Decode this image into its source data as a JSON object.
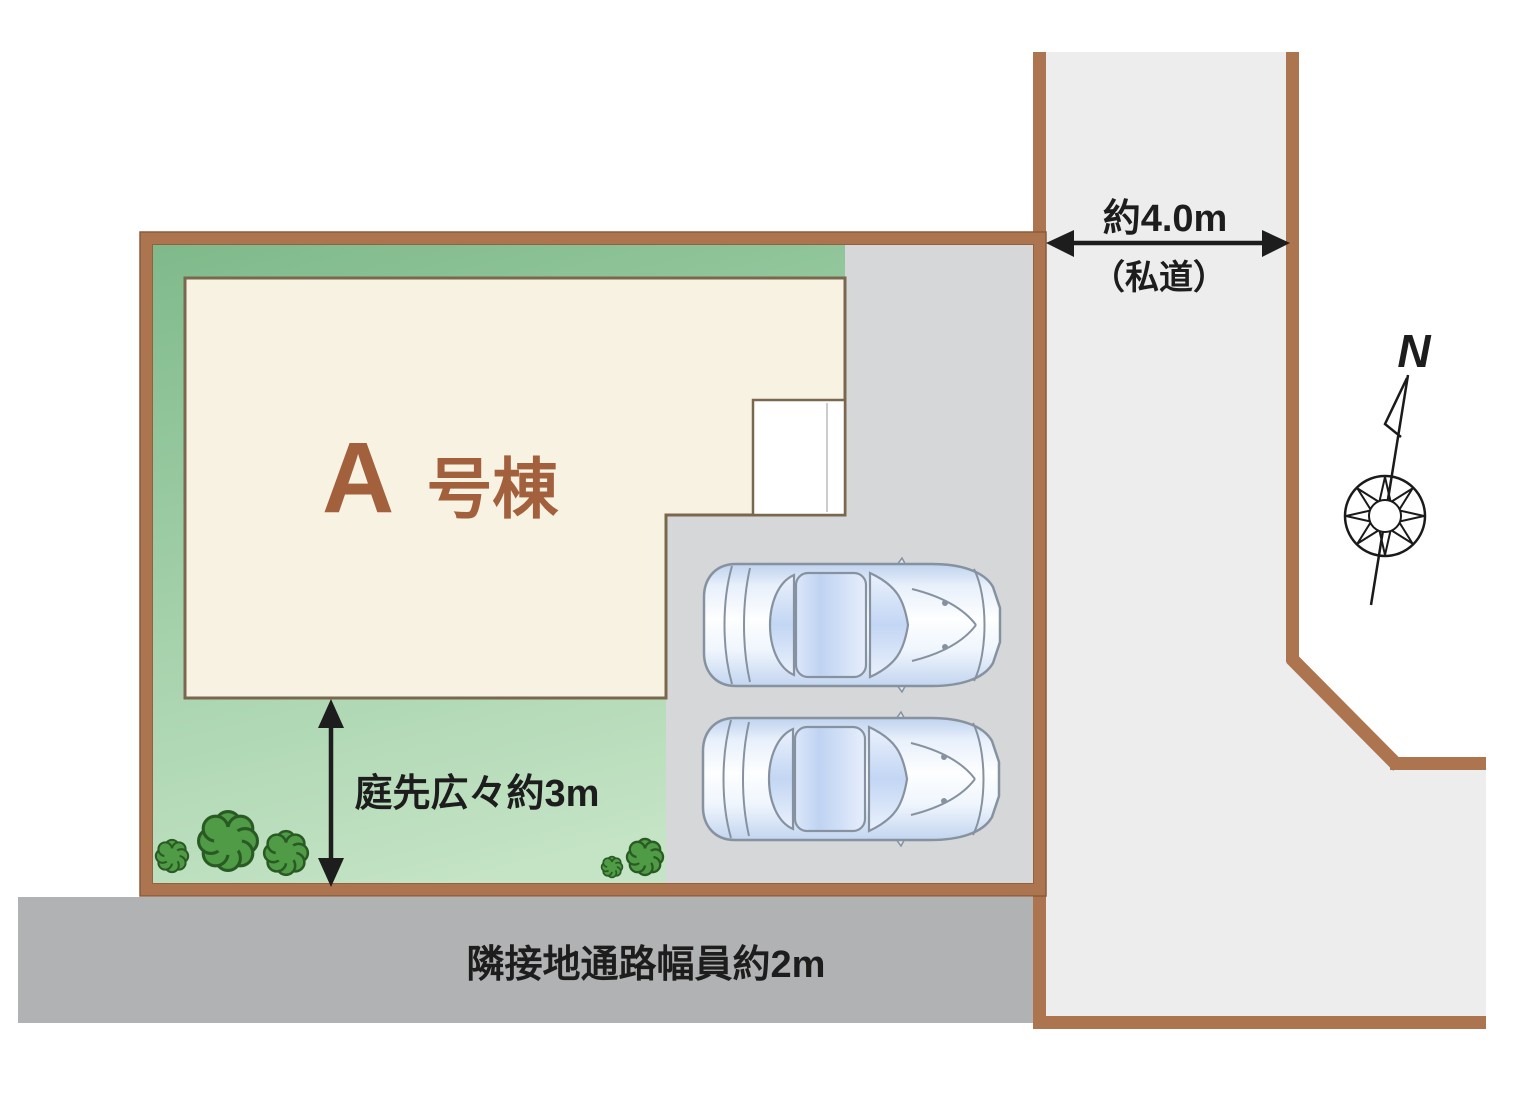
{
  "site_plan": {
    "building": {
      "letter": "A",
      "suffix": "号棟"
    },
    "garden": {
      "label": "庭先広々約3m"
    },
    "passage": {
      "label": "隣接地通路幅員約2m"
    },
    "road": {
      "width_label": "約4.0m",
      "type_label": "（私道）"
    },
    "compass": {
      "label": "N"
    }
  },
  "colors": {
    "plot_border": "#ad7450",
    "plot_border_edge": "#8a5c3b",
    "house_fill": "#f8f2e2",
    "house_border": "#7a684e",
    "garden_green_dark": "#7fba8b",
    "garden_green_light": "#c4e4c5",
    "parking_gray": "#d6d7d9",
    "road_gray": "#ededee",
    "passage_gray": "#b1b2b4",
    "tree_fill": "#4f9b46",
    "tree_stroke": "#2a5a24",
    "label_dark": "#1d1d1d",
    "building_text": "#a2613c",
    "porch_fill": "#ffffff",
    "car_outline": "#8792a0"
  }
}
